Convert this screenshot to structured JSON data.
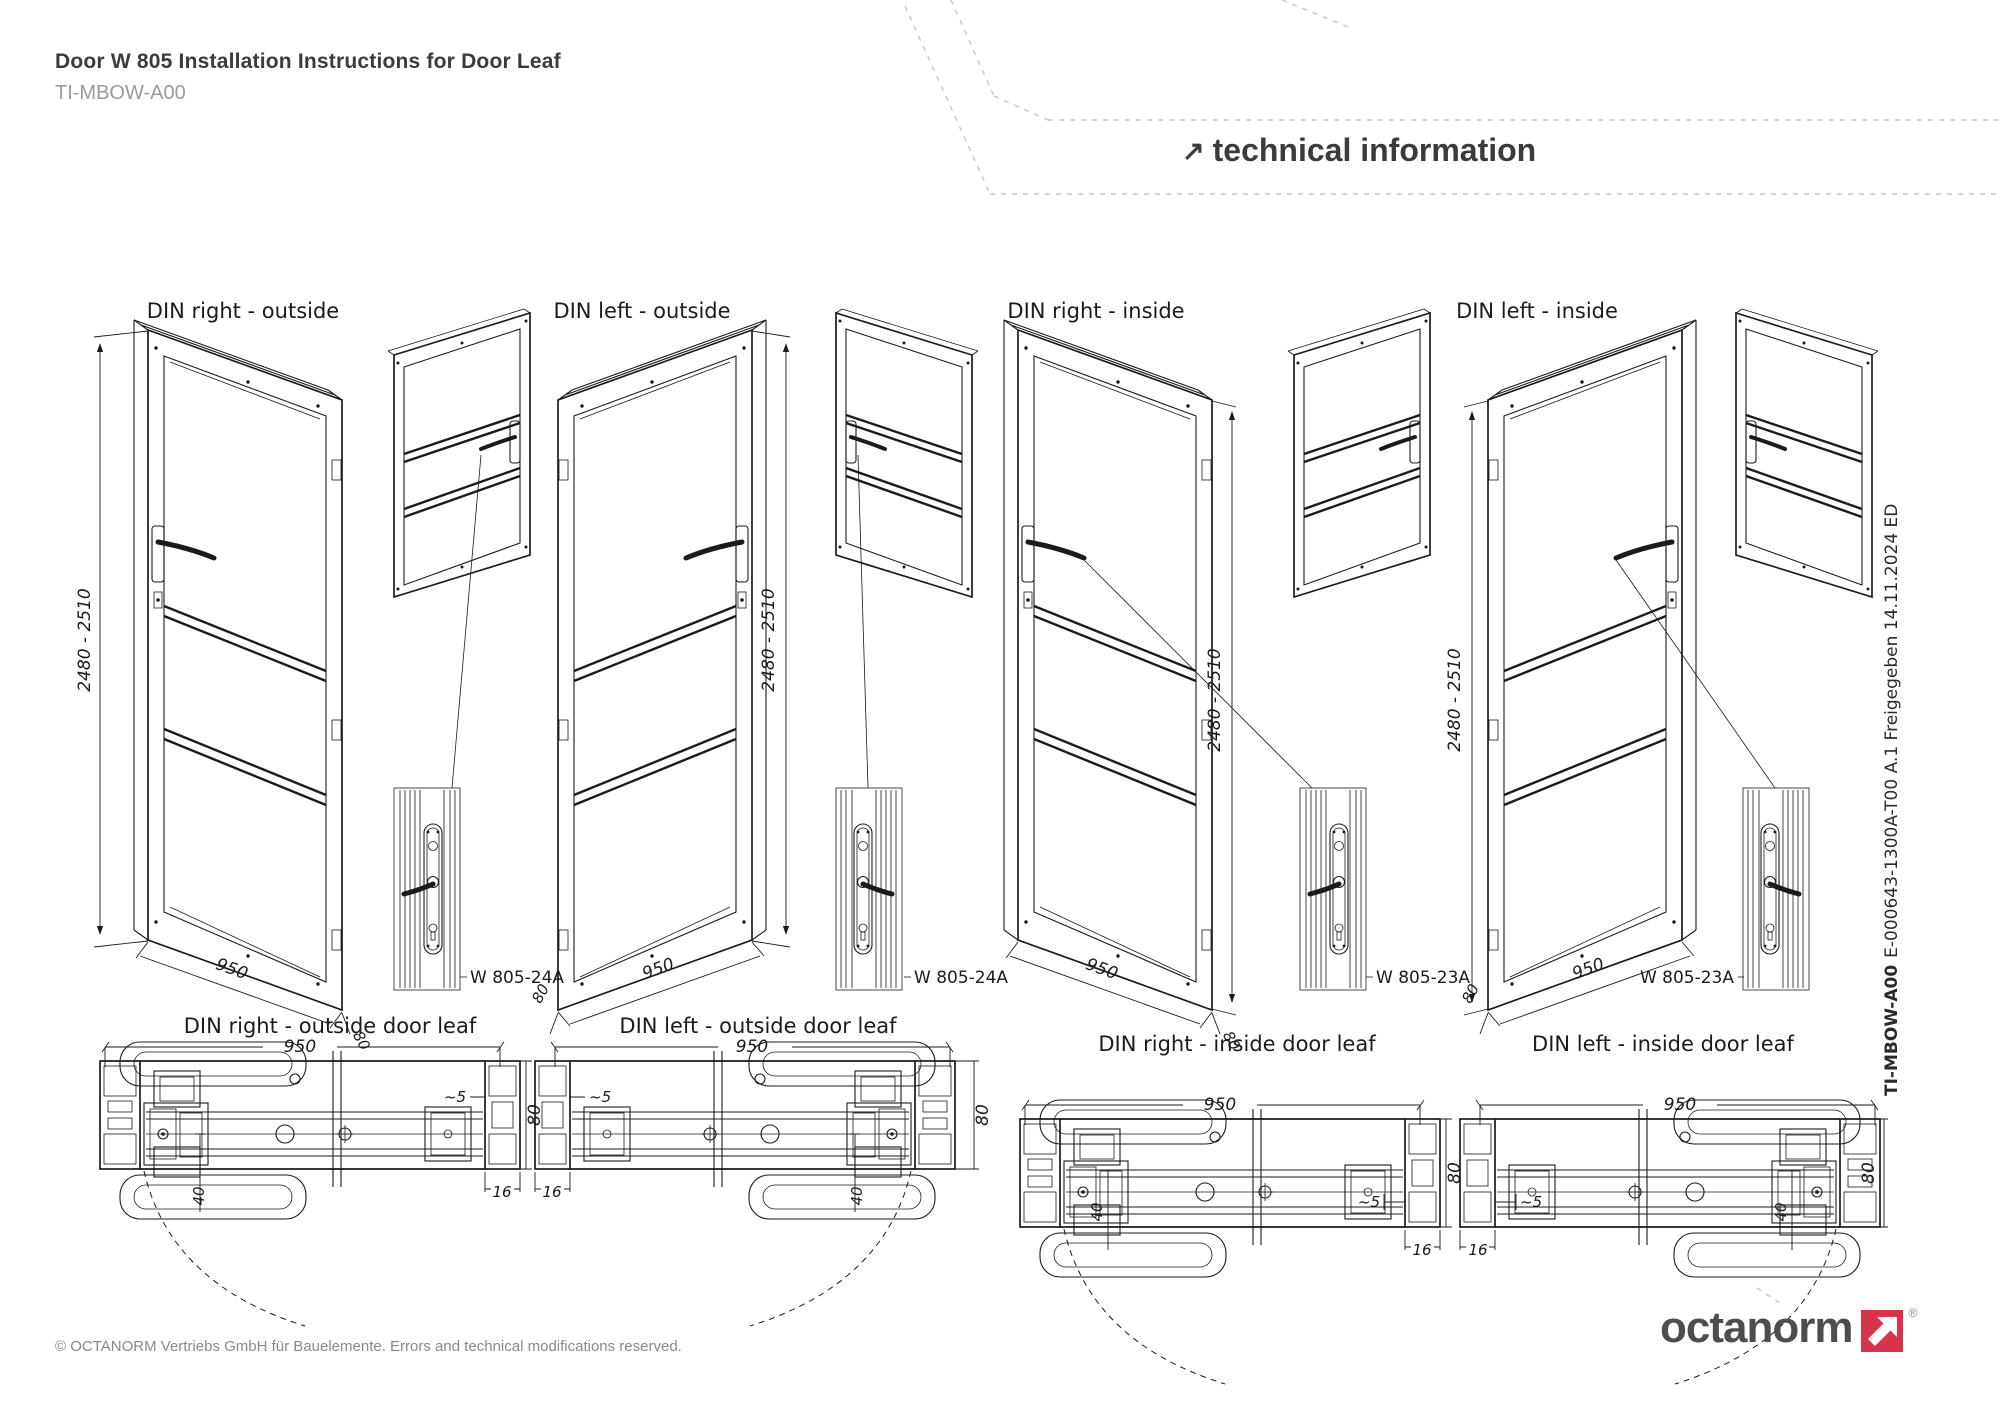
{
  "header": {
    "title": "Door W 805 Installation Instructions for Door Leaf",
    "code": "TI-MBOW-A00",
    "banner_arrow": "↗",
    "banner": "technical information"
  },
  "groups": [
    {
      "label": "DIN right - outside",
      "height": "2480 - 2510",
      "width": "950",
      "depth": "80",
      "part": "W 805-24A"
    },
    {
      "label": "DIN left - outside",
      "height": "2480 - 2510",
      "width": "950",
      "depth": "80",
      "part": "W 805-24A"
    },
    {
      "label": "DIN right - inside",
      "height": "2480 - 2510",
      "width": "950",
      "depth": "80",
      "part": "W 805-23A"
    },
    {
      "label": "DIN left - inside",
      "height": "2480 - 2510",
      "width": "950",
      "depth": "80",
      "part": "W 805-23A"
    }
  ],
  "sections": [
    {
      "label": "DIN right - outside door leaf",
      "width": "950",
      "offset": "40",
      "gap": "~5",
      "thickness": "80",
      "edge": "16"
    },
    {
      "label": "DIN left - outside door leaf",
      "width": "950",
      "offset": "40",
      "gap": "~5",
      "thickness": "80",
      "edge": "16"
    },
    {
      "label": "DIN right - inside door leaf",
      "width": "950",
      "offset": "40",
      "gap": "~5",
      "thickness": "80",
      "edge": "16"
    },
    {
      "label": "DIN left - inside door leaf",
      "width": "950",
      "offset": "40",
      "gap": "~5",
      "thickness": "80",
      "edge": "16"
    }
  ],
  "sidebar": {
    "code": "TI-MBOW-A00",
    "info": "E-000643-1300A-T00 A.1 Freigegeben 14.11.2024 ED"
  },
  "footer": {
    "copyright": "© OCTANORM Vertriebs GmbH für Bauelemente. Errors and technical modifications reserved.",
    "brand": "octanorm",
    "registered": "®"
  },
  "colors": {
    "accent_red": "#D6344B",
    "line": "#1b1b1b",
    "text_dark": "#3b3b39",
    "text_gray": "#9b9b99",
    "dash_decor": "#c9c7c5"
  }
}
